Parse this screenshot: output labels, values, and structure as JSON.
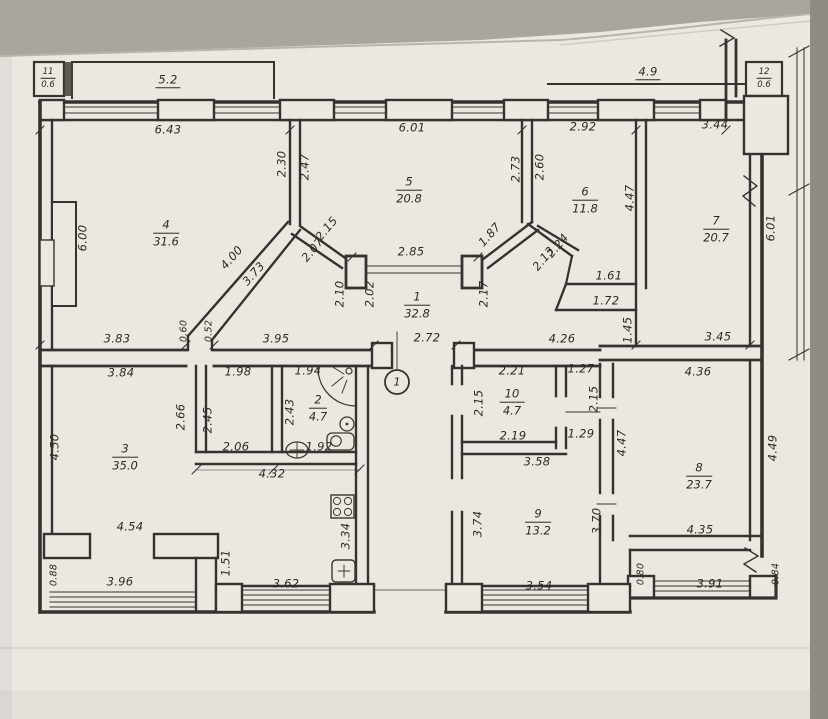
{
  "photo": {
    "background_color": "#a9a69d",
    "paper_color": "#eae8e1",
    "ink_color": "#35332f"
  },
  "plan": {
    "entrance_marker": {
      "label": "1"
    },
    "rooms": [
      {
        "number": "11",
        "area": "0.6",
        "x": 48,
        "y": 79,
        "s": 1
      },
      {
        "number": "12",
        "area": "0.6",
        "x": 764,
        "y": 79,
        "s": 1
      },
      {
        "number": "4",
        "area": "31.6",
        "x": 166,
        "y": 234
      },
      {
        "number": "5",
        "area": "20.8",
        "x": 409,
        "y": 191
      },
      {
        "number": "6",
        "area": "11.8",
        "x": 585,
        "y": 201
      },
      {
        "number": "7",
        "area": "20.7",
        "x": 716,
        "y": 230
      },
      {
        "number": "1",
        "area": "32.8",
        "x": 417,
        "y": 306
      },
      {
        "number": "2",
        "area": "4.7",
        "x": 318,
        "y": 409
      },
      {
        "number": "10",
        "area": "4.7",
        "x": 512,
        "y": 403
      },
      {
        "number": "3",
        "area": "35.0",
        "x": 125,
        "y": 458
      },
      {
        "number": "9",
        "area": "13.2",
        "x": 538,
        "y": 523
      },
      {
        "number": "8",
        "area": "23.7",
        "x": 699,
        "y": 477
      }
    ],
    "dimensions": [
      {
        "t": "5.2",
        "x": 168,
        "y": 81,
        "u": 1
      },
      {
        "t": "4.9",
        "x": 648,
        "y": 73,
        "u": 1
      },
      {
        "t": "6.43",
        "x": 168,
        "y": 130
      },
      {
        "t": "6.01",
        "x": 412,
        "y": 128
      },
      {
        "t": "2.92",
        "x": 583,
        "y": 127
      },
      {
        "t": "3.44",
        "x": 715,
        "y": 125
      },
      {
        "t": "2.30",
        "x": 282,
        "y": 164,
        "r": -90
      },
      {
        "t": "2.47",
        "x": 305,
        "y": 167,
        "r": -90
      },
      {
        "t": "2.73",
        "x": 516,
        "y": 169,
        "r": -90
      },
      {
        "t": "2.60",
        "x": 540,
        "y": 167,
        "r": -90
      },
      {
        "t": "4.47",
        "x": 630,
        "y": 198,
        "r": -90
      },
      {
        "t": "6.01",
        "x": 771,
        "y": 228,
        "r": -90
      },
      {
        "t": "6.00",
        "x": 83,
        "y": 238,
        "r": -90
      },
      {
        "t": "4.00",
        "x": 232,
        "y": 258,
        "r": -48
      },
      {
        "t": "3.73",
        "x": 254,
        "y": 274,
        "r": -48
      },
      {
        "t": "2.15",
        "x": 327,
        "y": 229,
        "r": -50
      },
      {
        "t": "2.07",
        "x": 313,
        "y": 250,
        "r": -50
      },
      {
        "t": "1.87",
        "x": 490,
        "y": 235,
        "r": -48
      },
      {
        "t": "2.24",
        "x": 558,
        "y": 246,
        "r": -50
      },
      {
        "t": "2.13",
        "x": 544,
        "y": 259,
        "r": -50
      },
      {
        "t": "2.85",
        "x": 411,
        "y": 252
      },
      {
        "t": "2.10",
        "x": 340,
        "y": 294,
        "r": -90
      },
      {
        "t": "2.02",
        "x": 370,
        "y": 294,
        "r": -90
      },
      {
        "t": "2.17",
        "x": 484,
        "y": 294,
        "r": -90
      },
      {
        "t": "1.61",
        "x": 609,
        "y": 276
      },
      {
        "t": "1.72",
        "x": 606,
        "y": 301
      },
      {
        "t": "1.45",
        "x": 628,
        "y": 330,
        "r": -90
      },
      {
        "t": "3.83",
        "x": 117,
        "y": 339
      },
      {
        "t": "0.60",
        "x": 184,
        "y": 331,
        "r": -90,
        "s": 1
      },
      {
        "t": "0.52",
        "x": 209,
        "y": 331,
        "r": -90,
        "s": 1
      },
      {
        "t": "3.95",
        "x": 276,
        "y": 339
      },
      {
        "t": "2.72",
        "x": 427,
        "y": 338
      },
      {
        "t": "4.26",
        "x": 562,
        "y": 339
      },
      {
        "t": "3.45",
        "x": 718,
        "y": 337
      },
      {
        "t": "3.84",
        "x": 121,
        "y": 373
      },
      {
        "t": "1.98",
        "x": 238,
        "y": 372
      },
      {
        "t": "1.94",
        "x": 308,
        "y": 371
      },
      {
        "t": "2.21",
        "x": 512,
        "y": 371
      },
      {
        "t": "1.27",
        "x": 581,
        "y": 369
      },
      {
        "t": "4.36",
        "x": 698,
        "y": 372
      },
      {
        "t": "2.15",
        "x": 479,
        "y": 403,
        "r": -90
      },
      {
        "t": "2.15",
        "x": 594,
        "y": 399,
        "r": -90
      },
      {
        "t": "2.66",
        "x": 181,
        "y": 417,
        "r": -90
      },
      {
        "t": "2.45",
        "x": 208,
        "y": 420,
        "r": -90
      },
      {
        "t": "2.43",
        "x": 290,
        "y": 412,
        "r": -90
      },
      {
        "t": "4.50",
        "x": 55,
        "y": 447,
        "r": -90
      },
      {
        "t": "2.19",
        "x": 513,
        "y": 436
      },
      {
        "t": "1.29",
        "x": 581,
        "y": 434
      },
      {
        "t": "2.06",
        "x": 236,
        "y": 447
      },
      {
        "t": "1.92",
        "x": 319,
        "y": 447
      },
      {
        "t": "4.32",
        "x": 272,
        "y": 474
      },
      {
        "t": "3.58",
        "x": 537,
        "y": 462
      },
      {
        "t": "4.47",
        "x": 622,
        "y": 443,
        "r": -90
      },
      {
        "t": "4.49",
        "x": 773,
        "y": 448,
        "r": -90
      },
      {
        "t": "4.54",
        "x": 130,
        "y": 527
      },
      {
        "t": "3.74",
        "x": 478,
        "y": 524,
        "r": -90
      },
      {
        "t": "3.70",
        "x": 597,
        "y": 521,
        "r": -90
      },
      {
        "t": "3.34",
        "x": 346,
        "y": 536,
        "r": -90
      },
      {
        "t": "1.51",
        "x": 226,
        "y": 563,
        "r": -90
      },
      {
        "t": "4.35",
        "x": 700,
        "y": 530
      },
      {
        "t": "0.88",
        "x": 54,
        "y": 575,
        "r": -90,
        "s": 1
      },
      {
        "t": "0.80",
        "x": 641,
        "y": 574,
        "r": -90,
        "s": 1
      },
      {
        "t": "0.84",
        "x": 776,
        "y": 574,
        "r": -90,
        "s": 1
      },
      {
        "t": "3.96",
        "x": 120,
        "y": 582
      },
      {
        "t": "3.62",
        "x": 286,
        "y": 584
      },
      {
        "t": "3.54",
        "x": 539,
        "y": 586
      },
      {
        "t": "3.91",
        "x": 710,
        "y": 584
      }
    ]
  }
}
